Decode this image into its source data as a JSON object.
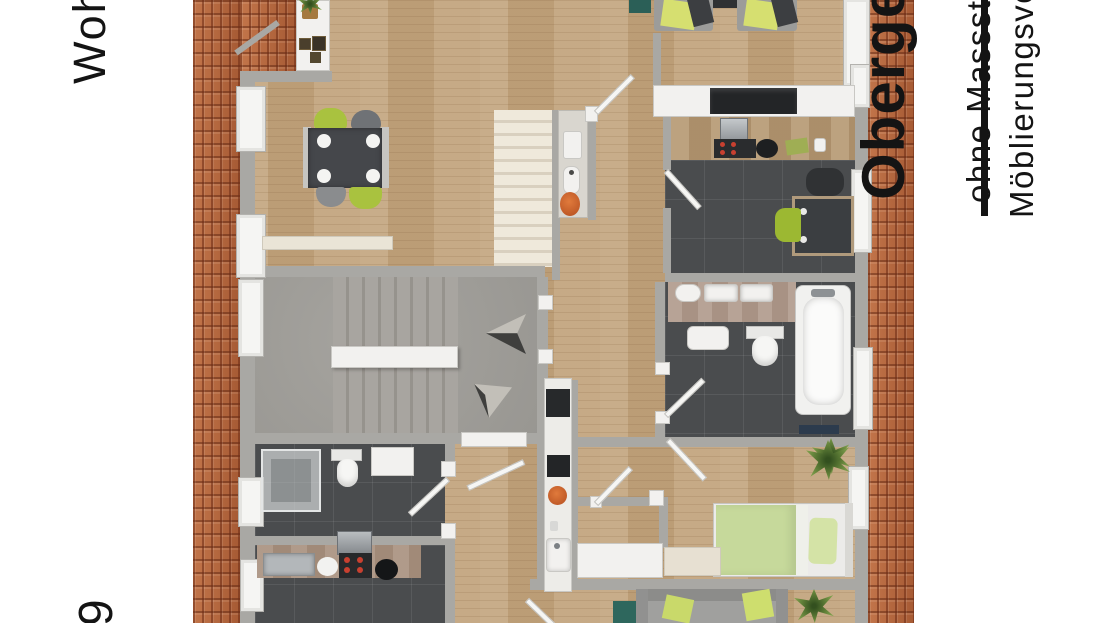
{
  "page": {
    "type": "floor-plan-rendering",
    "background": "#ffffff"
  },
  "labels": {
    "title": "Obergeschoss",
    "subtitle_line1": "ohne Massstab",
    "subtitle_line2": "Möblierungsvorschlag",
    "left_side": "Wohnfläche",
    "left_side_bottom_fragment": "9"
  },
  "colors": {
    "roof_tile": "#b4673e",
    "wood_floor": "#c3a57e",
    "dark_tile": "#4a4c4e",
    "wall_gray": "#a9a8a4",
    "fixture_white": "#f2f1ef",
    "stair_cream": "#ece6d8",
    "stairhall_gray": "#a09e99",
    "chair_green": "#a9c23f",
    "lounge_cushion_green": "#d6df70",
    "bed_green": "#c6d99b",
    "teal_accent": "#2e675d",
    "orange_accent": "#cd5f2f",
    "table_dark": "#45474b",
    "bath_mat_navy": "#2c3b4d",
    "burner_red": "#c84030",
    "text_black": "#141414"
  }
}
